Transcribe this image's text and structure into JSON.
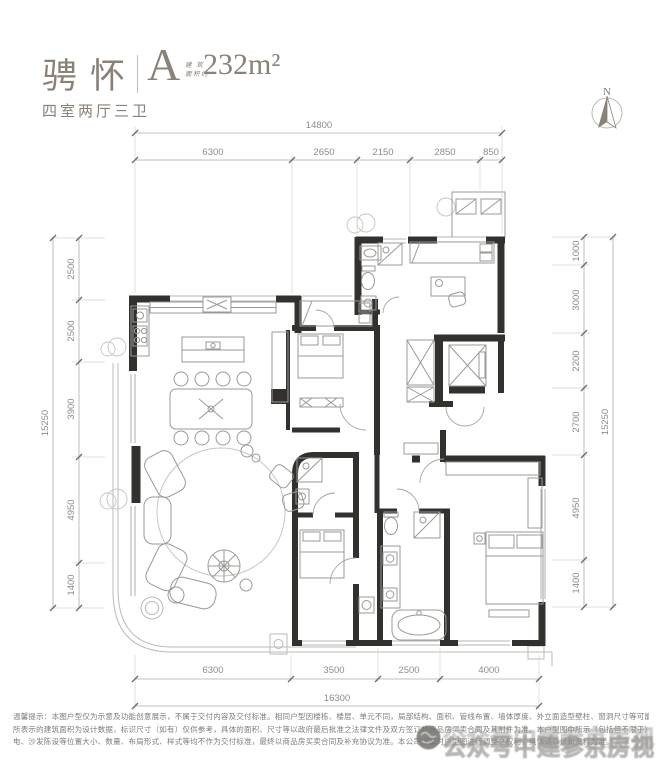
{
  "header": {
    "name": "骋怀",
    "type_label": "A",
    "area_prefix_line1": "建 筑",
    "area_prefix_line2": "面积约",
    "area_value": "232m²",
    "layout": "四室两厅三卫"
  },
  "compass": {
    "north_label": "N"
  },
  "dims": {
    "top": {
      "total": "14800",
      "segments": [
        "6300",
        "2650",
        "2150",
        "2850",
        "850"
      ]
    },
    "bottom": {
      "total": "16300",
      "segments": [
        "6300",
        "3500",
        "2500",
        "4000"
      ]
    },
    "left": {
      "total": "15250",
      "segments": [
        "2500",
        "2500",
        "3900",
        "4950",
        "1400"
      ]
    },
    "right": {
      "total": "15250",
      "segments": [
        "1000",
        "3000",
        "2200",
        "2700",
        "4950",
        "1400"
      ]
    }
  },
  "disclaimer": {
    "lines": [
      "温馨提示：本图户型仅为示意及功能创意展示，不属于交付内容及交付标准。相同户型因楼栋、楼层、单元不同，局部结构、面积、管线布置、墙体厚度、外立面造型壁柱、窗洞尺寸等可能有所不同，户型中",
      "所表示的建筑面积为设计数据，标识尺寸（如有）仅供参考，具体的面积、尺寸等以政府最后批准之法律文件及双方签订的商品房买卖合同及其附件为准。本户型图中所示（包括但不限于）家具家",
      "电、沙发陈设等位置大小、数量、布局形式、样式等均不作为交付标准，最终以商品房买卖合同及补充协议为准。本公司保留对户型图进行调整之权利，具体请以最新资料为准。"
    ]
  },
  "watermark": {
    "text": "公众号中建参京房视"
  },
  "colors": {
    "accent": "#8a8177",
    "wall": "#33312d",
    "dim_text": "#8f8d89"
  }
}
